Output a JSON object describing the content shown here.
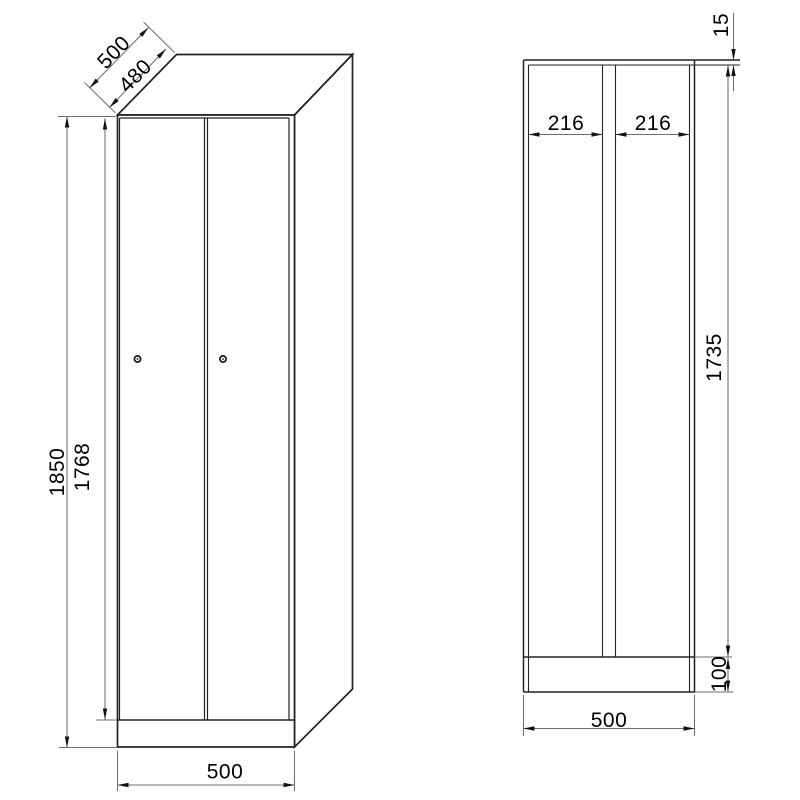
{
  "title": "Two-door locker technical drawing",
  "views": {
    "front": {
      "label": "front-perspective-view",
      "dims": {
        "depth_total": "500",
        "depth_top": "480",
        "height_total": "1850",
        "door_height": "1768",
        "width": "500"
      }
    },
    "section": {
      "label": "front-section-view",
      "dims": {
        "top_gap": "15",
        "compartment_left_width": "216",
        "compartment_right_width": "216",
        "inner_height": "1735",
        "plinth_height": "100",
        "width": "500"
      }
    }
  },
  "colors": {
    "outline": "#222222",
    "dim_line": "#6e6e6e",
    "arrow": "#111111",
    "text": "#000000",
    "background": "#ffffff"
  }
}
